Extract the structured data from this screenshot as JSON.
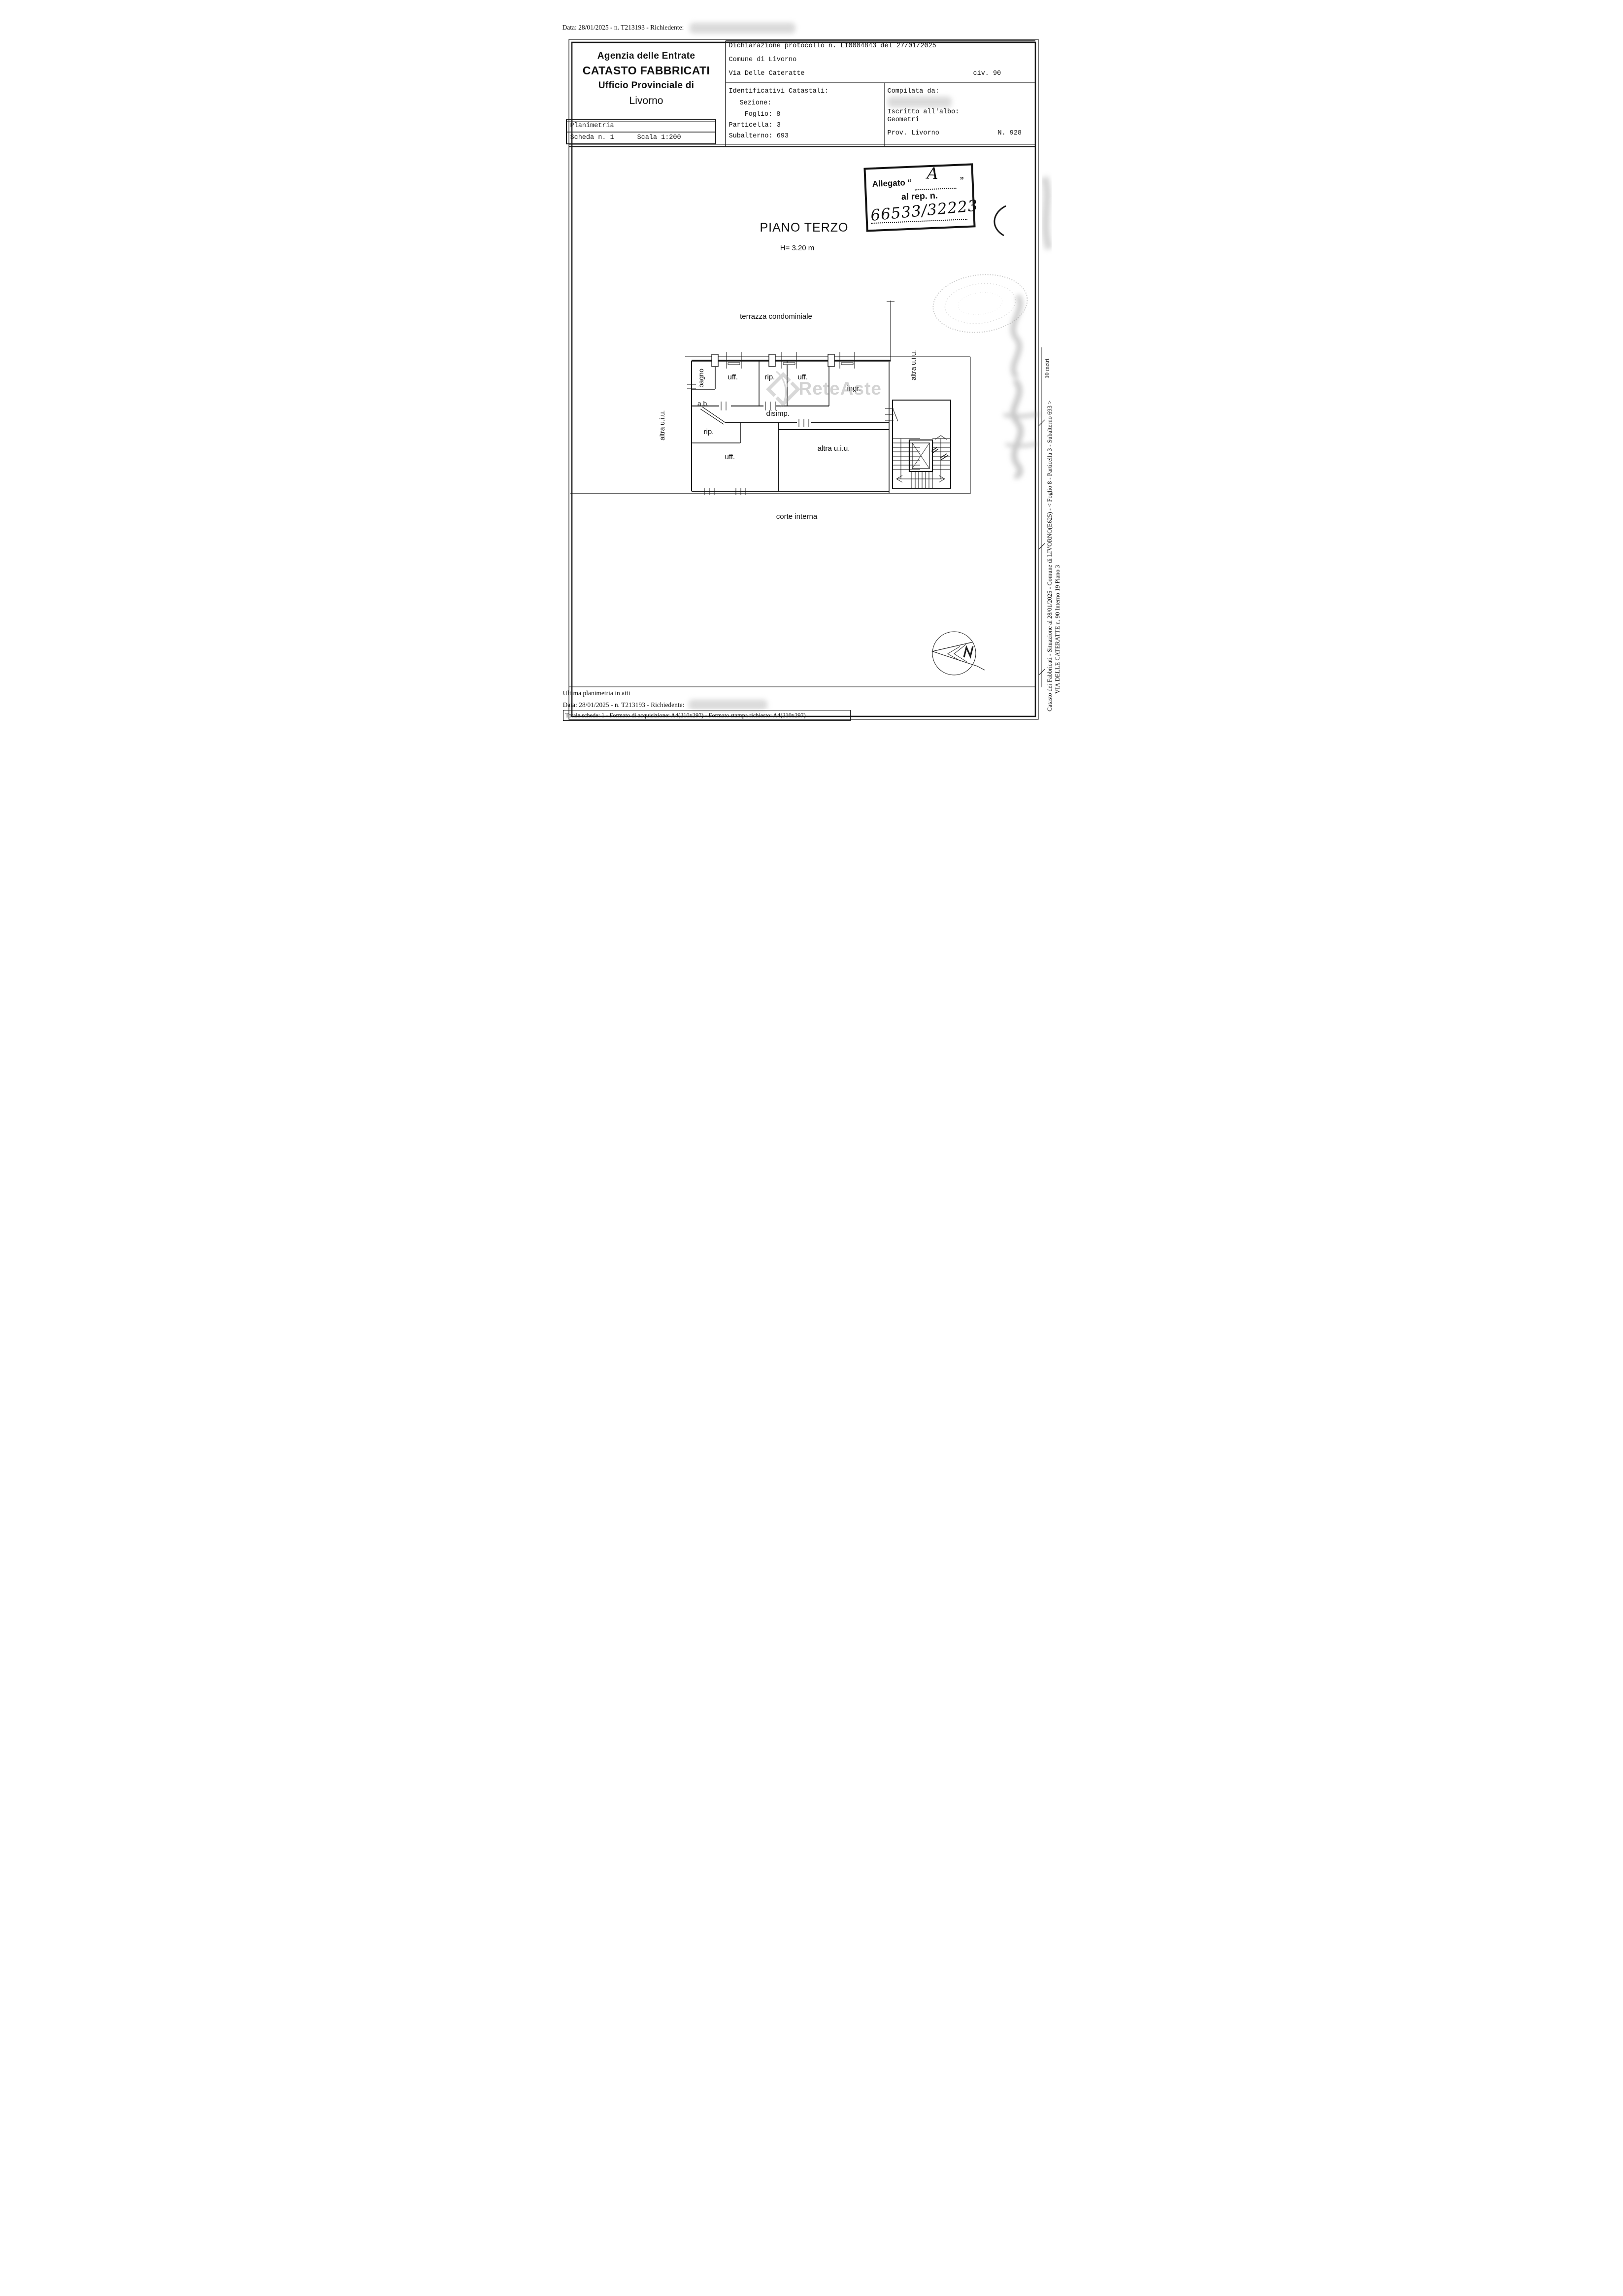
{
  "header": {
    "top_line": "Data: 28/01/2025 - n. T213193 - Richiedente:",
    "agency": [
      "Agenzia delle Entrate",
      "CATASTO FABBRICATI",
      "Ufficio Provinciale di",
      "Livorno"
    ],
    "planimetria": "Planimetria",
    "scheda": "Scheda n. 1",
    "scala": "Scala 1:200",
    "declaration": "Dichiarazione protocollo n. LI0004843 del 27/01/2025",
    "comune": "Comune di Livorno",
    "street": "Via Delle Cateratte",
    "civic": "civ. 90",
    "identificativi": "Identificativi Catastali:",
    "sezione": "Sezione:",
    "foglio": "Foglio: 8",
    "particella": "Particella: 3",
    "subalterno": "Subalterno: 693",
    "compilata": "Compilata da:",
    "iscritto": "Iscritto all'albo:",
    "albo": "Geometri",
    "prov": "Prov. Livorno",
    "albo_n": "N. 928"
  },
  "stamp": {
    "prefix": "Allegato “",
    "letter": "A",
    "suffix": "”",
    "line2": "al rep. n.",
    "number": "66533/32223"
  },
  "plan": {
    "title": "PIANO TERZO",
    "height": "H= 3.20 m",
    "scale_label": "10 metri",
    "labels": {
      "terrazza": "terrazza condominiale",
      "corte": "corte interna",
      "altra_left": "altra u.i.u.",
      "altra_right": "altra u.i.u.",
      "altra_main": "altra u.i.u.",
      "bagno": "bagno",
      "ab": "a.b.",
      "uff1": "uff.",
      "rip1": "rip.",
      "uff2": "uff.",
      "ingr": "ingr.",
      "disimp": "disimp.",
      "rip2": "rip.",
      "uff3": "uff."
    }
  },
  "watermark": {
    "text": "ReteAste"
  },
  "margin": {
    "line1": "Catasto dei Fabbricati - Situazione al 28/01/2025 - Comune di LIVORNO(E625) - < Foglio 8 - Particella 3 - Subalterno 693 >",
    "line2": "VIA DELLE CATERATTE n. 90  Interno 19 Piano 3"
  },
  "footer": {
    "ultima": "Ultima planimetria in atti",
    "data_line": "Data: 28/01/2025 - n. T213193 - Richiedente:",
    "totale": "Totale schede: 1 - Formato di acquisizione: A4(210x297)  - Formato stampa richiesto: A4(210x297)"
  }
}
